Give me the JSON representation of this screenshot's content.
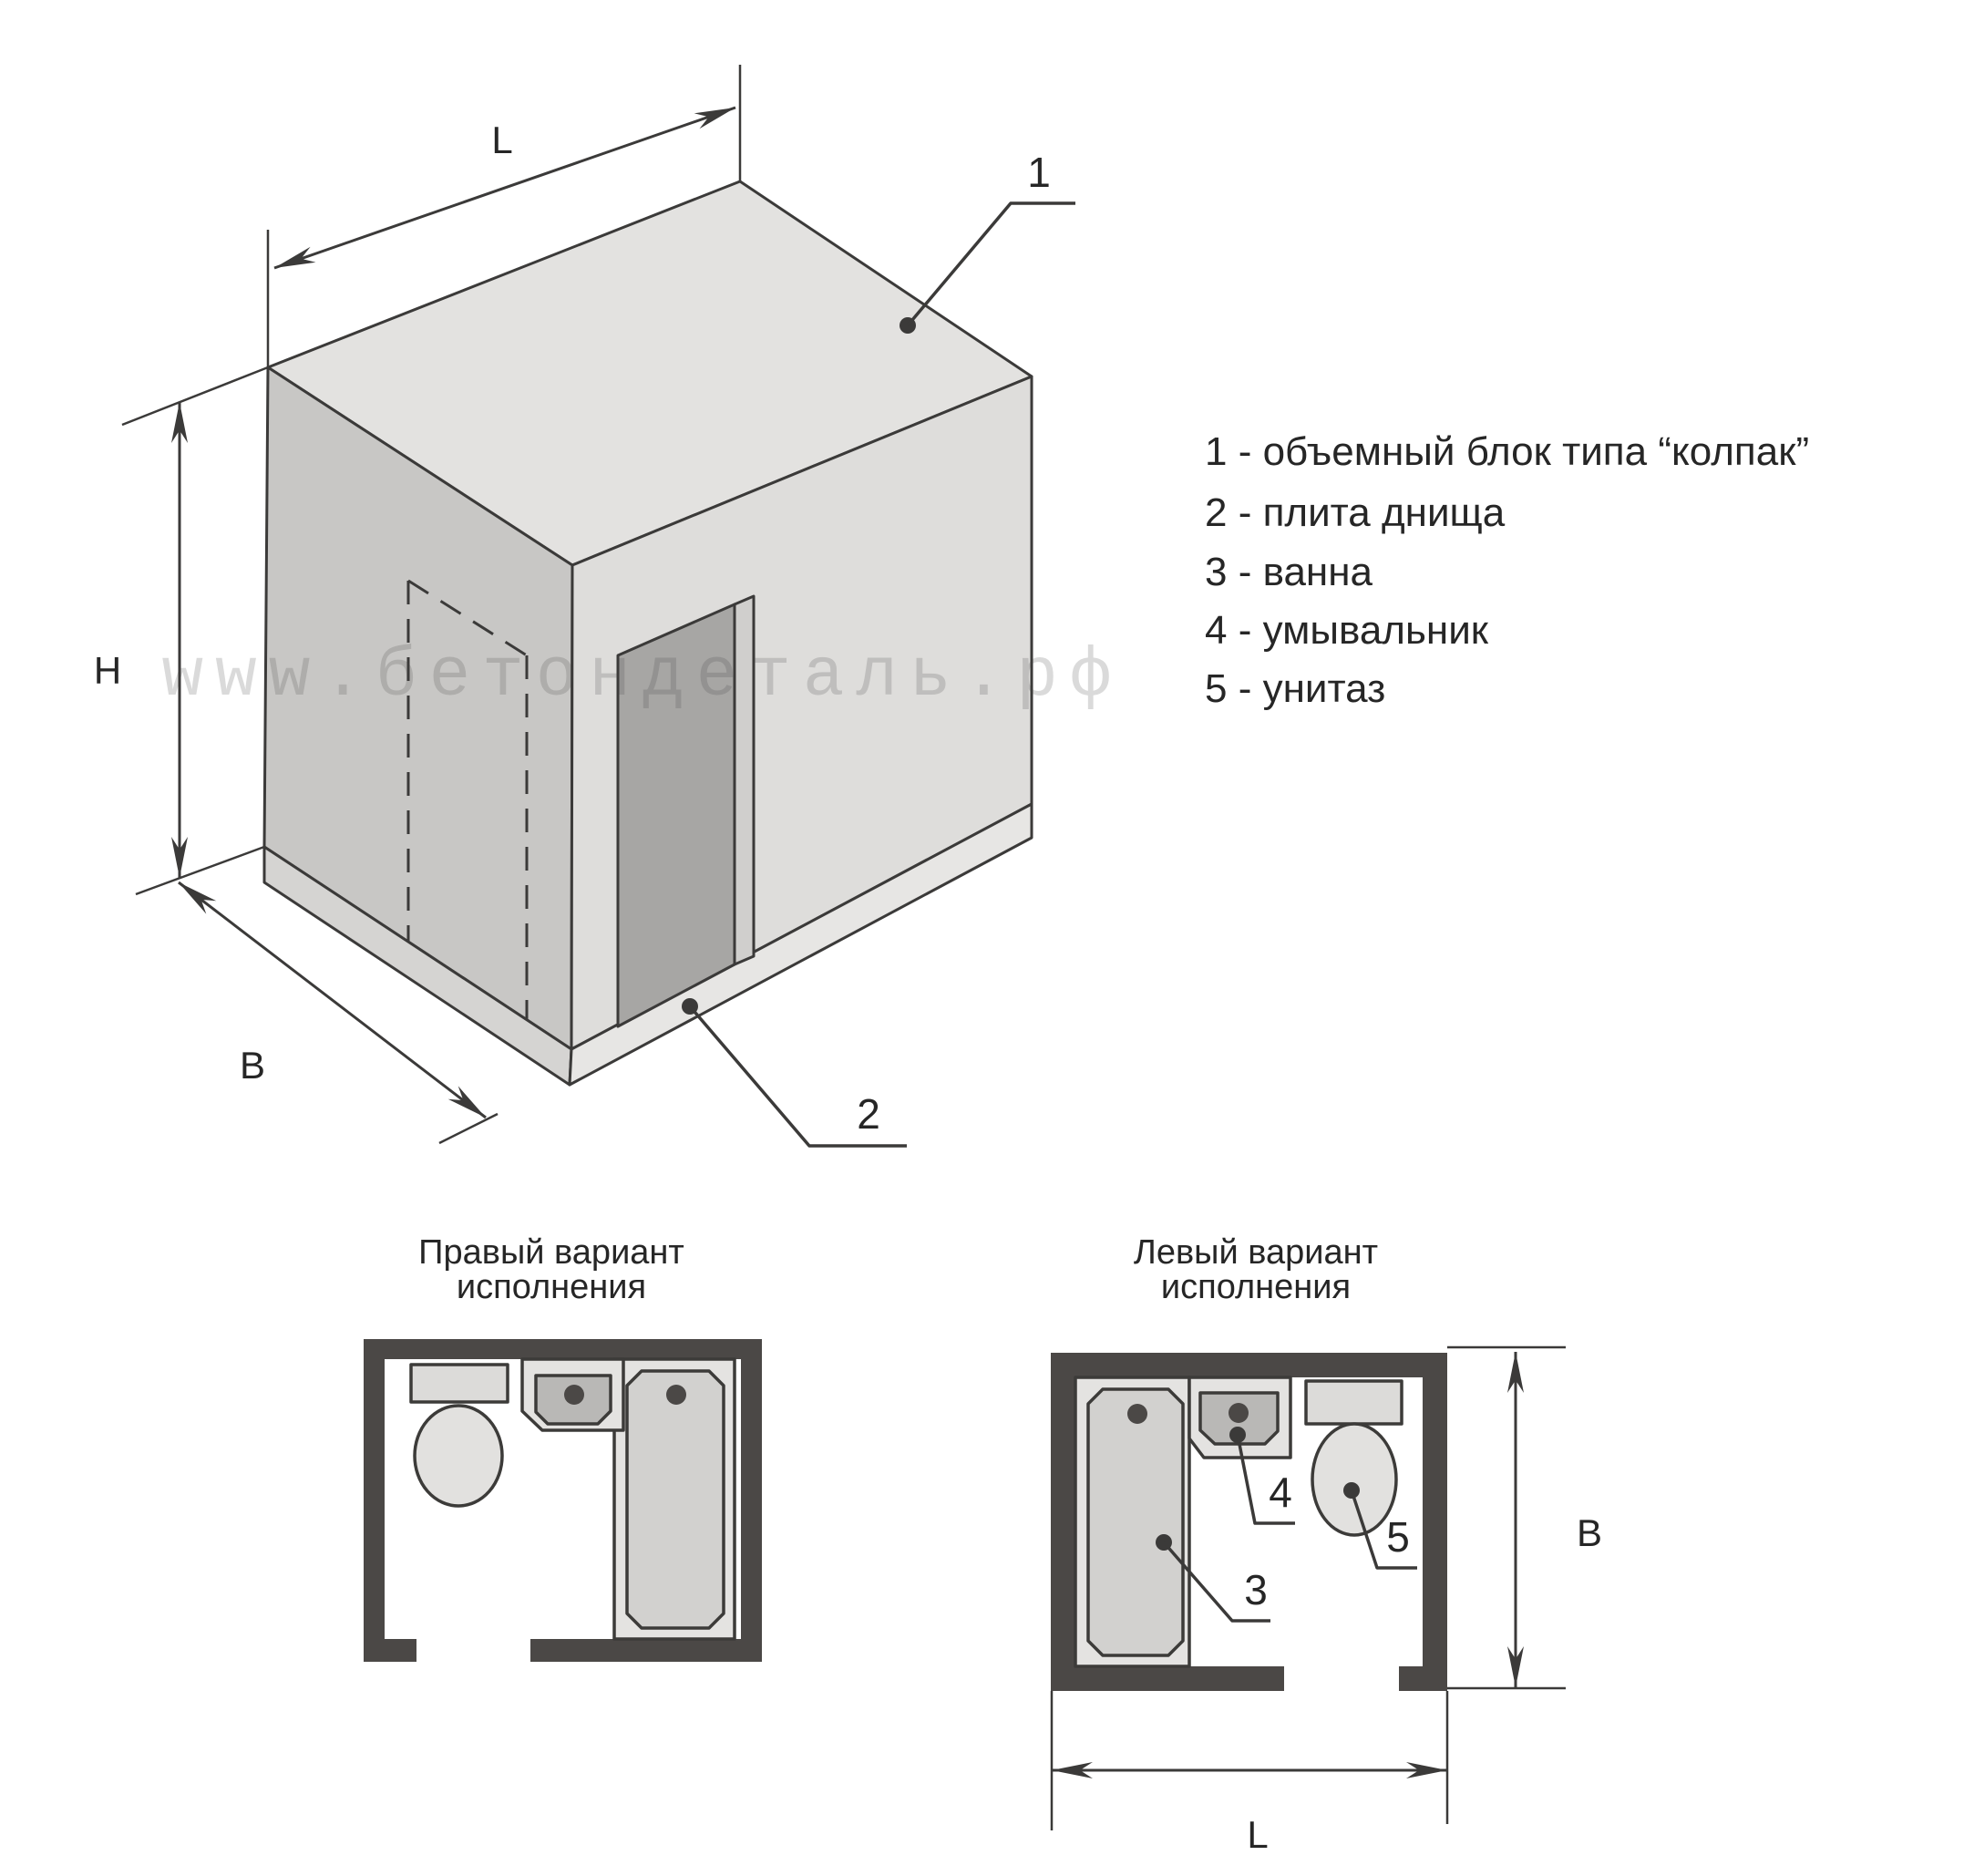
{
  "watermark": {
    "text": "www.бетондеталь.рф"
  },
  "legend": {
    "items": [
      "1 - объемный блок типа “колпак”",
      "2 - плита днища",
      "3 - ванна",
      "4 - умывальник",
      "5 - унитаз"
    ]
  },
  "isometric": {
    "dims": {
      "l": "L",
      "h": "H",
      "b": "B"
    },
    "callouts": {
      "c1": "1",
      "c2": "2"
    }
  },
  "plans": {
    "right": {
      "title1": "Правый вариант",
      "title2": "исполнения"
    },
    "left": {
      "title1": "Левый вариант",
      "title2": "исполнения",
      "callouts": {
        "c3": "3",
        "c4": "4",
        "c5": "5"
      },
      "dims": {
        "b": "B",
        "l": "L"
      }
    }
  },
  "colors": {
    "line": "#3b3a39",
    "outline": "#3c3b39",
    "text": "#262626",
    "wall": "#4b4846",
    "face_top": "#e3e2e0",
    "face_left": "#c8c7c5",
    "face_right": "#dedddb",
    "slab_left": "#d5d4d2",
    "slab_right": "#e7e6e4",
    "door_opening": "#a7a6a4",
    "door_jamb": "#d0cfcd",
    "fixture_light": "#e4e3e1",
    "fixture_mid": "#d2d1cf",
    "fixture_dark": "#b9b8b6",
    "cistern": "#dcdbd9",
    "toilet_bowl": "#e2e1df",
    "watermark": "rgba(70,70,70,0.20)"
  }
}
